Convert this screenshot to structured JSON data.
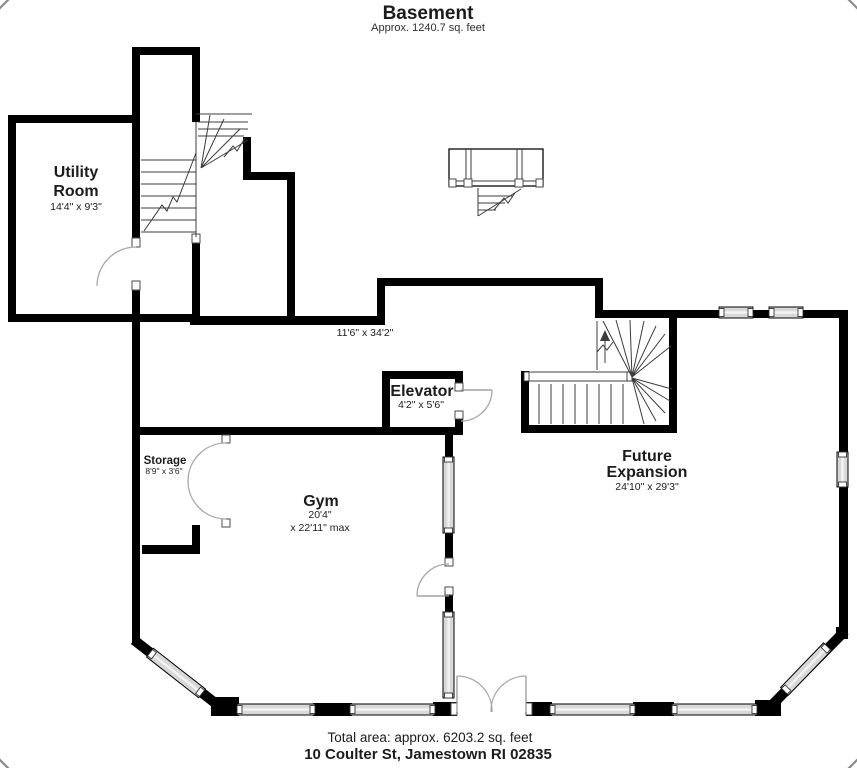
{
  "page": {
    "title": "Basement",
    "subtitle": "Approx. 1240.7 sq. feet"
  },
  "rooms": {
    "utility": {
      "name1": "Utility",
      "name2": "Room",
      "dims": "14'4\" x 9'3\""
    },
    "hall": {
      "dims": "11'6\" x 34'2\""
    },
    "elevator": {
      "name": "Elevator",
      "dims": "4'2\" x 5'6\""
    },
    "storage": {
      "name": "Storage",
      "dims": "8'9\" x 3'6\""
    },
    "gym": {
      "name": "Gym",
      "dims1": "20'4\"",
      "dims2": "x 22'11\" max"
    },
    "future": {
      "name1": "Future",
      "name2": "Expansion",
      "dims": "24'10\" x 29'3\""
    }
  },
  "footer": {
    "total": "Total area: approx. 6203.2 sq. feet",
    "address": "10 Coulter St, Jamestown RI 02835"
  },
  "colors": {
    "wall": "#000000",
    "window_fill": "#d8d8d8",
    "door_arc": "#a8a8a8",
    "stair_line": "#3c3c3c",
    "text": "#1c1c1c",
    "background": "#ffffff"
  }
}
